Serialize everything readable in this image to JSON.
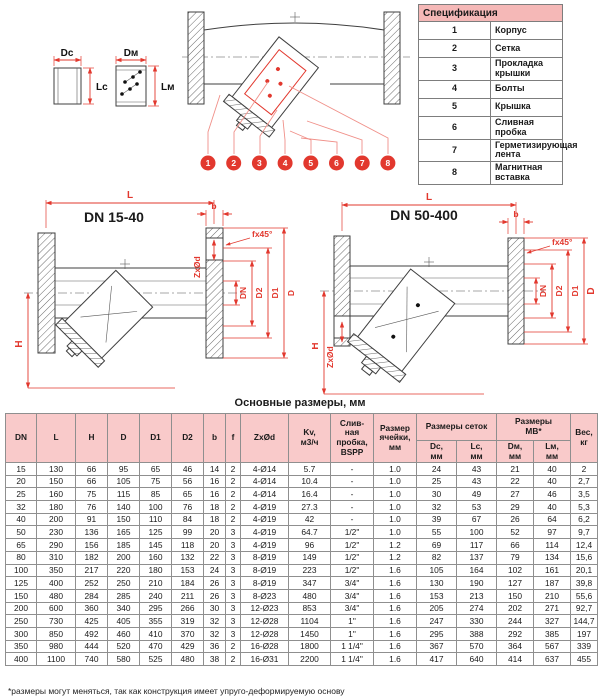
{
  "colors": {
    "accent_red": "#e2382e",
    "leader_pink": "#f09089",
    "table_header_pink": "#f9caca",
    "spec_header_pink": "#f5b8b7"
  },
  "spec_table": {
    "title": "Спецификация",
    "items": [
      {
        "num": "1",
        "label": "Корпус"
      },
      {
        "num": "2",
        "label": "Сетка"
      },
      {
        "num": "3",
        "label": "Прокладка крышки"
      },
      {
        "num": "4",
        "label": "Болты"
      },
      {
        "num": "5",
        "label": "Крышка"
      },
      {
        "num": "6",
        "label": "Сливная пробка"
      },
      {
        "num": "7",
        "label": "Герметизирующая лента"
      },
      {
        "num": "8",
        "label": "Магнитная вставка"
      }
    ]
  },
  "mini": {
    "dc": "Dc",
    "lc": "Lc",
    "dm": "Dм",
    "lm": "Lм"
  },
  "overview": {
    "callouts": [
      "1",
      "2",
      "3",
      "4",
      "5",
      "6",
      "7",
      "8"
    ]
  },
  "drawings": {
    "left": {
      "title": "DN 15-40"
    },
    "right": {
      "title": "DN 50-400"
    },
    "labels": {
      "L": "L",
      "b": "b",
      "f45": "fx45°",
      "zxod": "ZxØd",
      "dn": "DN",
      "d2": "D2",
      "d1": "D1",
      "d": "D",
      "h": "H"
    }
  },
  "dimensions_table": {
    "title": "Основные размеры, мм",
    "headers_flat": [
      "DN",
      "L",
      "H",
      "D",
      "D1",
      "D2",
      "b",
      "f",
      "ZxØd",
      "Kv,\nм3/ч",
      "Слив-\nная\nпробка,\nBSPP",
      "Размер\nячейки,\nмм"
    ],
    "group_screens": "Размеры сеток",
    "group_mv": "Размеры\nМВ*",
    "sub_headers": [
      "Dc,\nмм",
      "Lc,\nмм",
      "Dм,\nмм",
      "Lм,\nмм"
    ],
    "weight_header": "Вес,\nкг",
    "rows": [
      [
        "15",
        "130",
        "66",
        "95",
        "65",
        "46",
        "14",
        "2",
        "4-Ø14",
        "5.7",
        "-",
        "1.0",
        "24",
        "43",
        "21",
        "40",
        "2"
      ],
      [
        "20",
        "150",
        "66",
        "105",
        "75",
        "56",
        "16",
        "2",
        "4-Ø14",
        "10.4",
        "-",
        "1.0",
        "25",
        "43",
        "22",
        "40",
        "2,7"
      ],
      [
        "25",
        "160",
        "75",
        "115",
        "85",
        "65",
        "16",
        "2",
        "4-Ø14",
        "16.4",
        "-",
        "1.0",
        "30",
        "49",
        "27",
        "46",
        "3,5"
      ],
      [
        "32",
        "180",
        "76",
        "140",
        "100",
        "76",
        "18",
        "2",
        "4-Ø19",
        "27.3",
        "-",
        "1.0",
        "32",
        "53",
        "29",
        "40",
        "5,3"
      ],
      [
        "40",
        "200",
        "91",
        "150",
        "110",
        "84",
        "18",
        "2",
        "4-Ø19",
        "42",
        "-",
        "1.0",
        "39",
        "67",
        "26",
        "64",
        "6,2"
      ],
      [
        "50",
        "230",
        "136",
        "165",
        "125",
        "99",
        "20",
        "3",
        "4-Ø19",
        "64.7",
        "1/2\"",
        "1.0",
        "55",
        "100",
        "52",
        "97",
        "9,7"
      ],
      [
        "65",
        "290",
        "156",
        "185",
        "145",
        "118",
        "20",
        "3",
        "4-Ø19",
        "96",
        "1/2\"",
        "1.2",
        "69",
        "117",
        "66",
        "114",
        "12,4"
      ],
      [
        "80",
        "310",
        "182",
        "200",
        "160",
        "132",
        "22",
        "3",
        "8-Ø19",
        "149",
        "1/2\"",
        "1.2",
        "82",
        "137",
        "79",
        "134",
        "15,6"
      ],
      [
        "100",
        "350",
        "217",
        "220",
        "180",
        "153",
        "24",
        "3",
        "8-Ø19",
        "223",
        "1/2\"",
        "1.6",
        "105",
        "164",
        "102",
        "161",
        "20,1"
      ],
      [
        "125",
        "400",
        "252",
        "250",
        "210",
        "184",
        "26",
        "3",
        "8-Ø19",
        "347",
        "3/4\"",
        "1.6",
        "130",
        "190",
        "127",
        "187",
        "39,8"
      ],
      [
        "150",
        "480",
        "284",
        "285",
        "240",
        "211",
        "26",
        "3",
        "8-Ø23",
        "480",
        "3/4\"",
        "1.6",
        "153",
        "213",
        "150",
        "210",
        "55,6"
      ],
      [
        "200",
        "600",
        "360",
        "340",
        "295",
        "266",
        "30",
        "3",
        "12-Ø23",
        "853",
        "3/4\"",
        "1.6",
        "205",
        "274",
        "202",
        "271",
        "92,7"
      ],
      [
        "250",
        "730",
        "425",
        "405",
        "355",
        "319",
        "32",
        "3",
        "12-Ø28",
        "1104",
        "1\"",
        "1.6",
        "247",
        "330",
        "244",
        "327",
        "144,7"
      ],
      [
        "300",
        "850",
        "492",
        "460",
        "410",
        "370",
        "32",
        "3",
        "12-Ø28",
        "1450",
        "1\"",
        "1.6",
        "295",
        "388",
        "292",
        "385",
        "197"
      ],
      [
        "350",
        "980",
        "444",
        "520",
        "470",
        "429",
        "36",
        "2",
        "16-Ø28",
        "1800",
        "1 1/4\"",
        "1.6",
        "367",
        "570",
        "364",
        "567",
        "339"
      ],
      [
        "400",
        "1100",
        "740",
        "580",
        "525",
        "480",
        "38",
        "2",
        "16-Ø31",
        "2200",
        "1 1/4\"",
        "1.6",
        "417",
        "640",
        "414",
        "637",
        "455"
      ]
    ],
    "footnote": "*размеры могут меняться, так как конструкция имеет упруго-деформируемую основу"
  }
}
